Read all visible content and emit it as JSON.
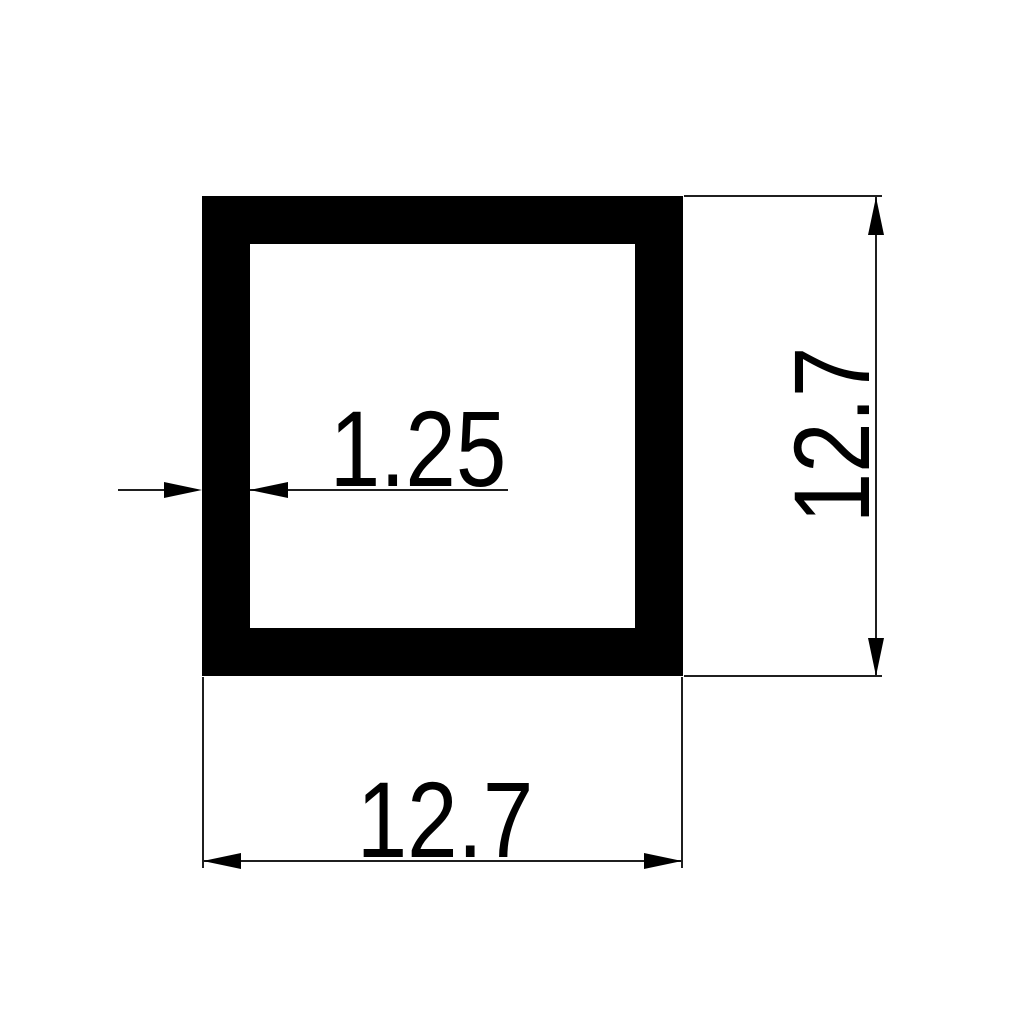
{
  "drawing": {
    "type": "technical-cross-section",
    "background_color": "#ffffff",
    "line_color": "#1f1f1f",
    "profile_fill_color": "#000000",
    "shape": "square-tube",
    "dimensions": {
      "outer_width": {
        "label": "12.7",
        "placement": "bottom"
      },
      "outer_height": {
        "label": "12.7",
        "placement": "right",
        "rotation_deg": -90
      },
      "wall_thickness": {
        "label": "1.25",
        "placement": "left-wall"
      }
    }
  }
}
